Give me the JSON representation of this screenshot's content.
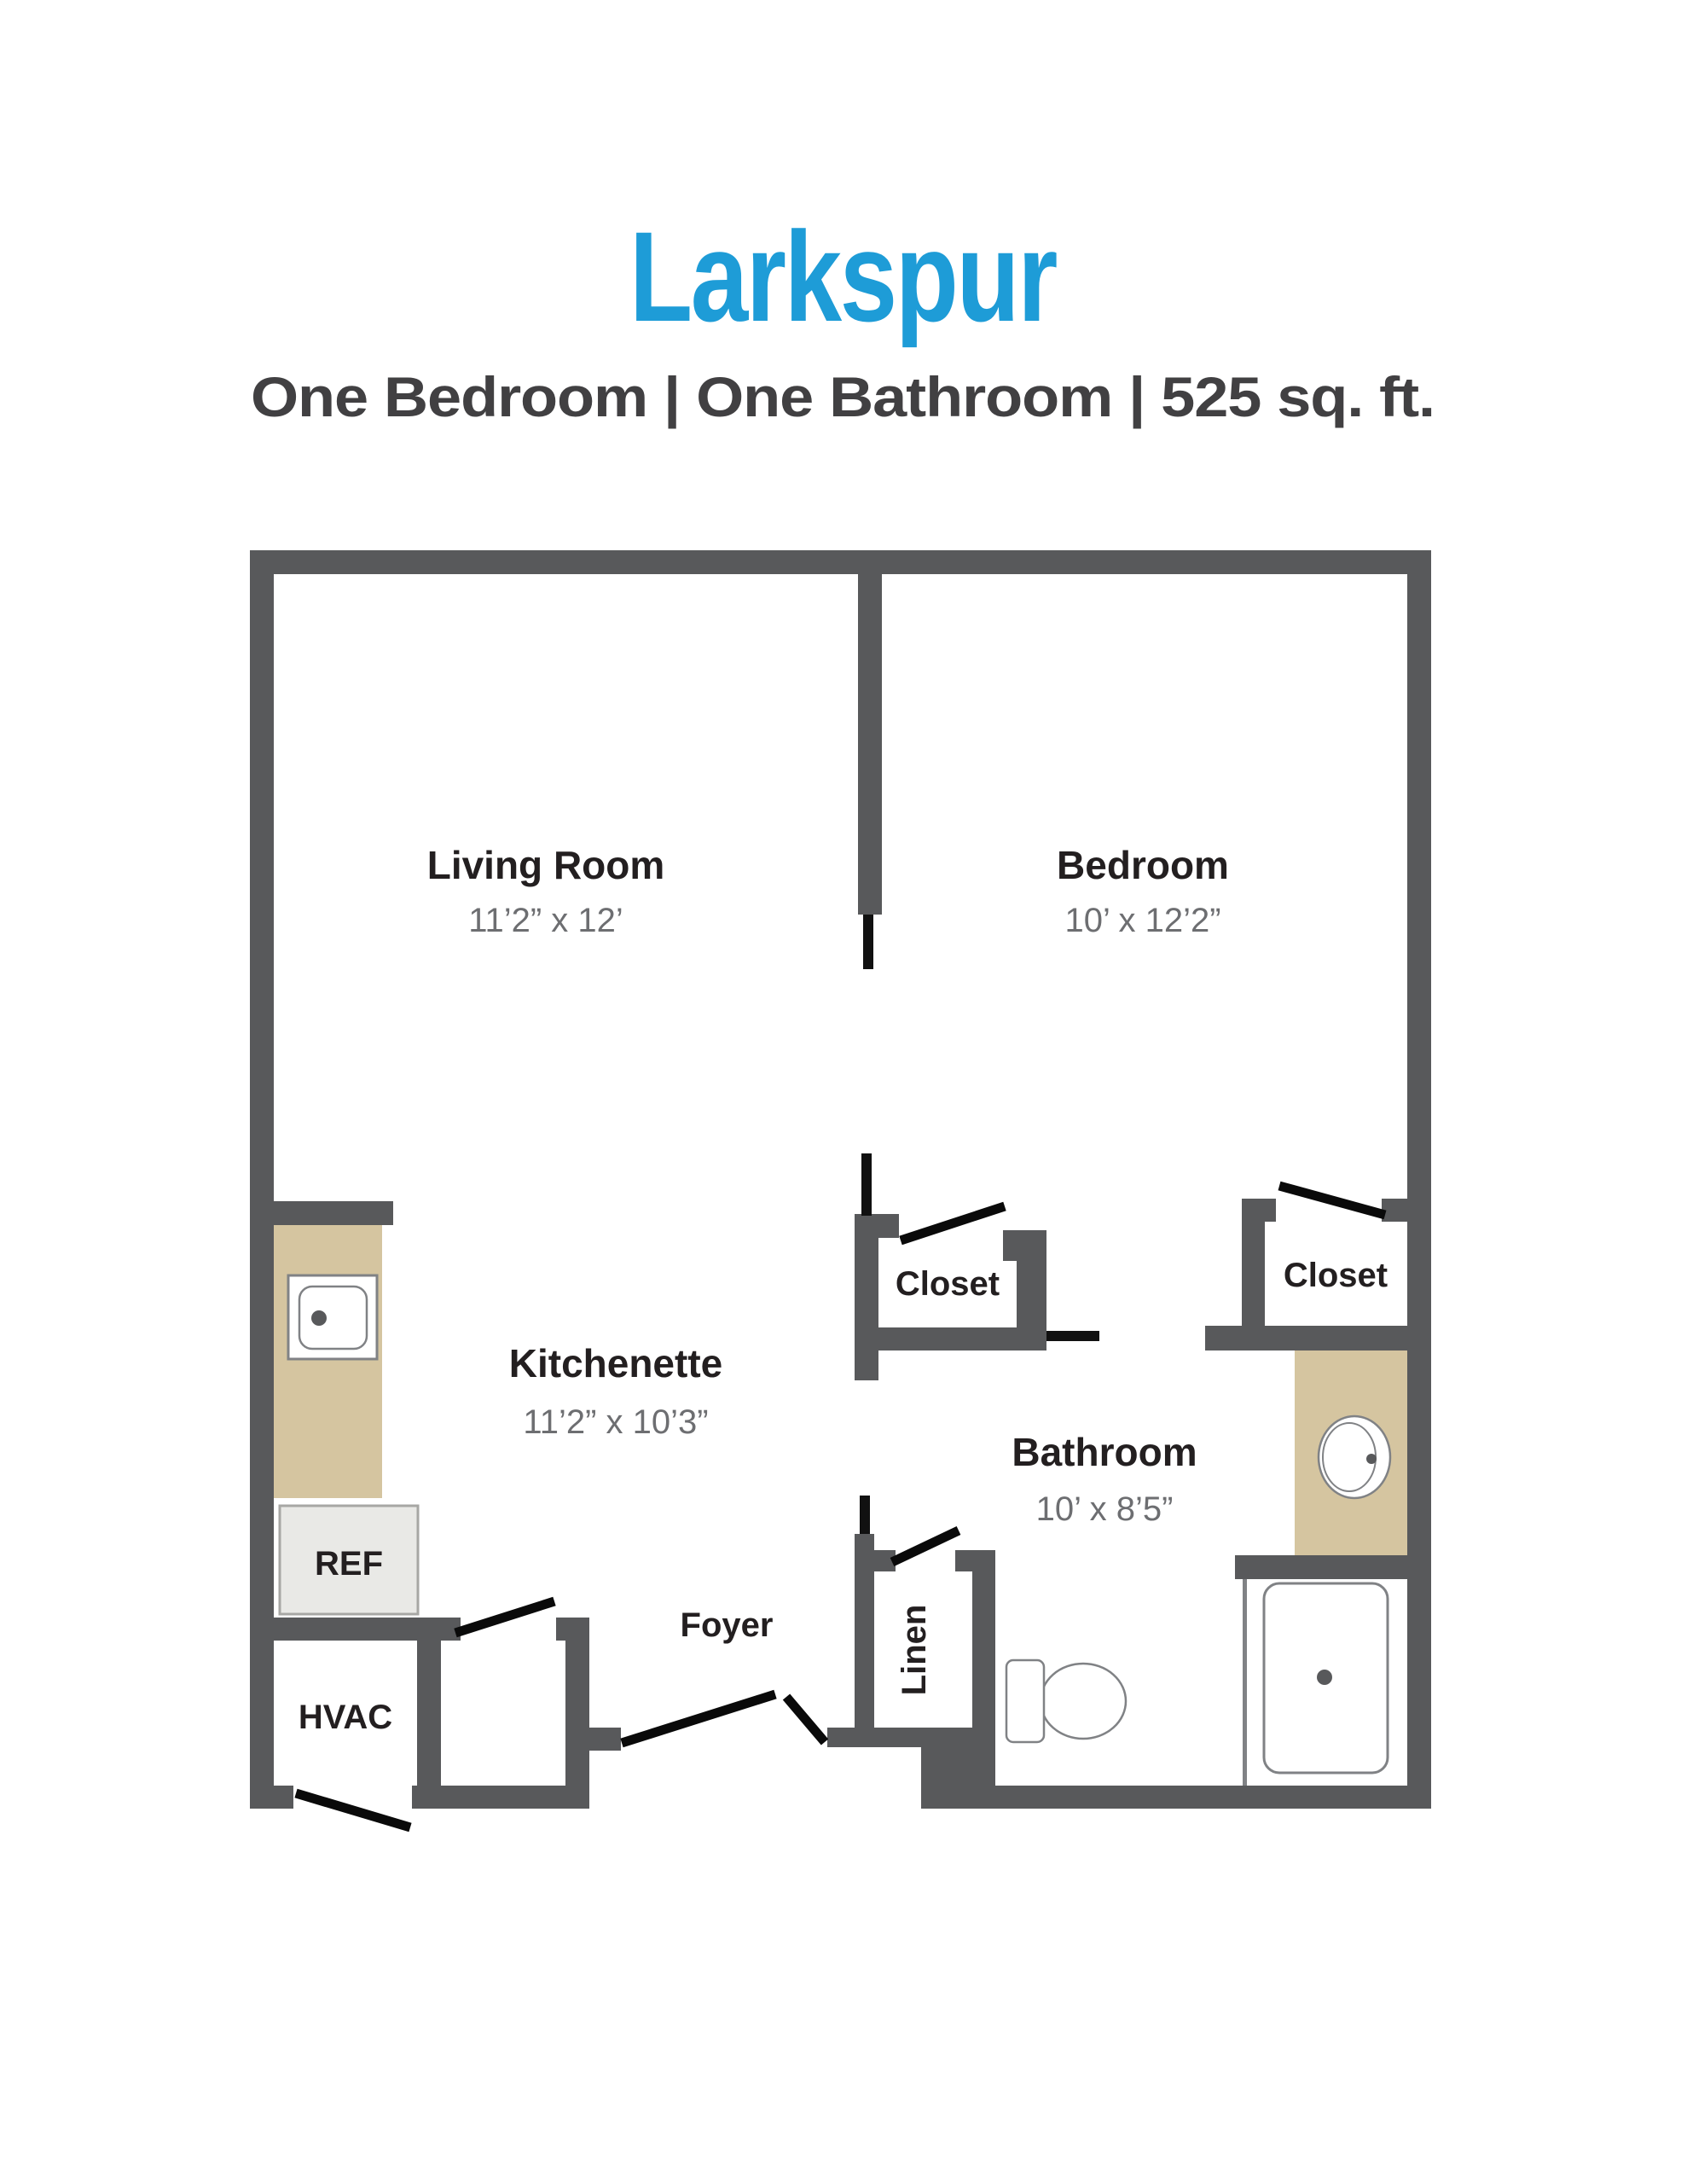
{
  "header": {
    "title": "Larkspur",
    "subtitle": "One Bedroom | One Bathroom | 525 sq. ft.",
    "title_color": "#1E9CD7",
    "subtitle_color": "#414042"
  },
  "colors": {
    "wall": "#58595B",
    "counter": "#D5C5A0",
    "appliance_fill": "#E9E9E6",
    "door_line": "#0a0a0a",
    "room_text": "#231F20",
    "dim_text": "#6D6E71"
  },
  "rooms": {
    "living": {
      "name": "Living Room",
      "dims": "11’2” x 12’"
    },
    "bedroom": {
      "name": "Bedroom",
      "dims": "10’ x 12’2”"
    },
    "kitchenette": {
      "name": "Kitchenette",
      "dims": "11’2” x 10’3”"
    },
    "bathroom": {
      "name": "Bathroom",
      "dims": "10’ x 8’5”"
    },
    "hall_closet": {
      "name": "Closet"
    },
    "bedroom_closet": {
      "name": "Closet"
    },
    "linen": {
      "name": "Linen"
    },
    "foyer": {
      "name": "Foyer"
    },
    "hvac": {
      "name": "HVAC"
    },
    "refrigerator": {
      "name": "REF"
    }
  },
  "fixtures": {
    "kitchen_sink": "sink",
    "vanity_sink": "oval-sink",
    "toilet": "toilet",
    "shower": "shower-pan-with-drain"
  }
}
